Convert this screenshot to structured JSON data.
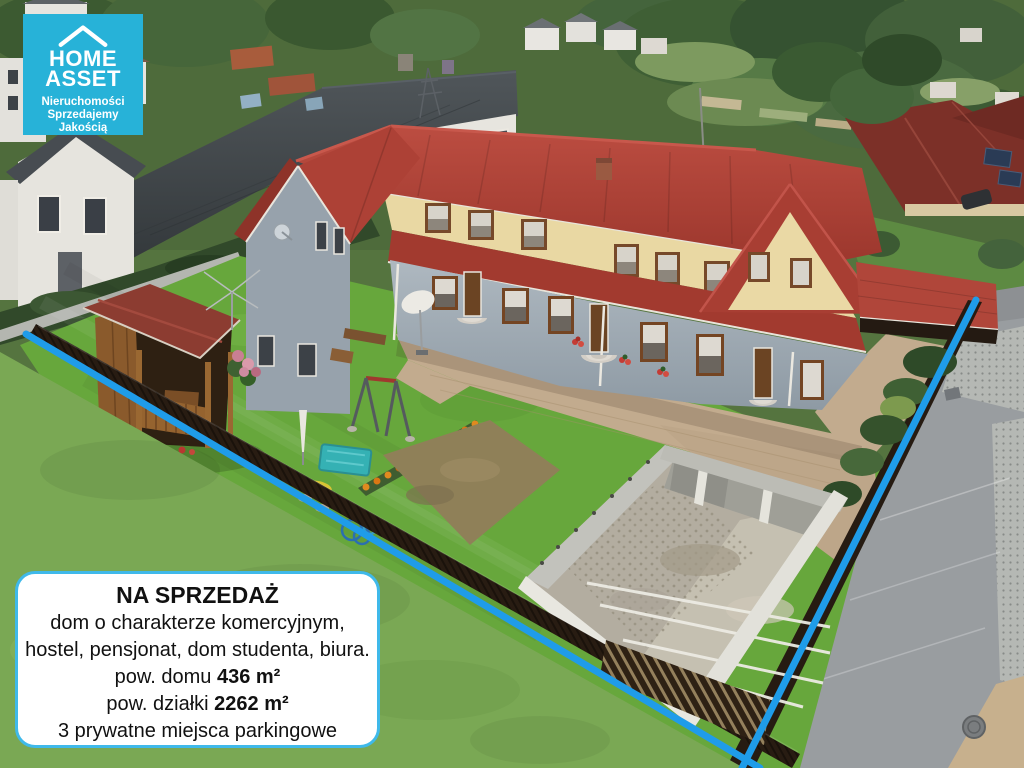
{
  "overlay": {
    "logo": {
      "brand_line1": "HOME",
      "brand_line2": "ASSET",
      "tagline_lines": [
        "Nieruchomości",
        "Sprzedajemy",
        "Jakością"
      ],
      "background_color": "#27b2d8",
      "text_color": "#ffffff"
    },
    "info_box": {
      "title": "NA SPRZEDAŻ",
      "description_line1": "dom o charakterze komercyjnym,",
      "description_line2": "hostel, pensjonat, dom studenta, biura.",
      "house_area_label": "pow. domu ",
      "house_area_value": "436 m²",
      "plot_area_label": "pow. działki ",
      "plot_area_value": "2262 m²",
      "parking_line": "3 prywatne miejsca parkingowe",
      "border_color": "#3fb9ea",
      "background_color": "#ffffff",
      "text_color": "#111111"
    },
    "boundary_line_color": "#1f9ce9"
  },
  "scene_colors": {
    "main_roof_red": "#ae4338",
    "cream_wall": "#e9d8a3",
    "gray_wall": "#9aa6b0",
    "inner_lawn": "#67a73c",
    "outer_lawn": "#7aa854",
    "fence_brown": "#271c12",
    "street_gray": "#999da0",
    "courtyard_tan": "#c2ab8e",
    "concrete": "#b3ada0"
  }
}
